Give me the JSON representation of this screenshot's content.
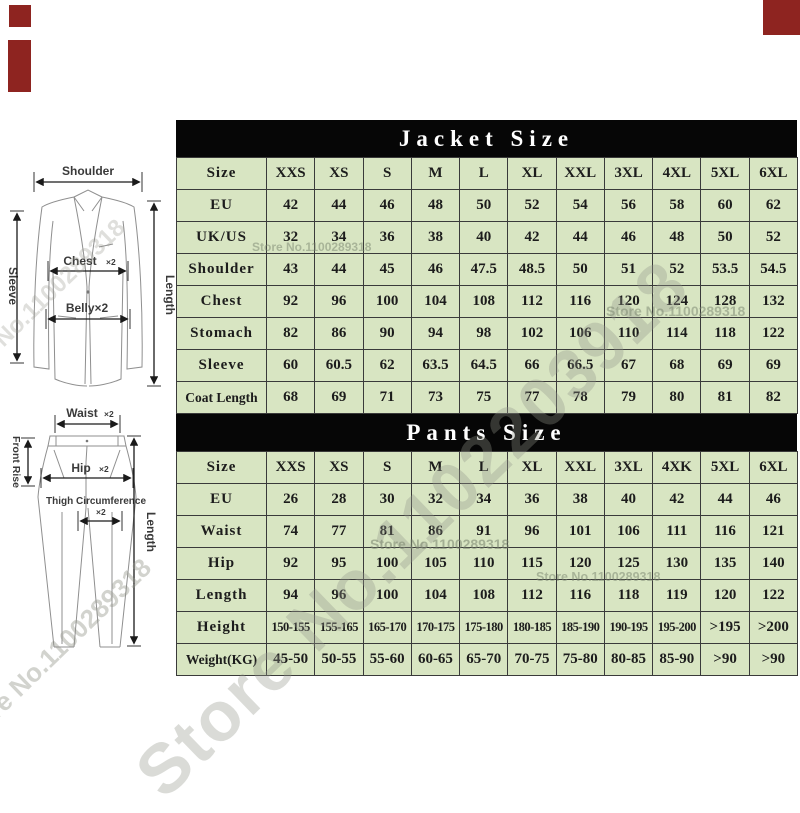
{
  "jacket": {
    "title": "Jacket Size",
    "rows": [
      {
        "label": "Size",
        "values": [
          "XXS",
          "XS",
          "S",
          "M",
          "L",
          "XL",
          "XXL",
          "3XL",
          "4XL",
          "5XL",
          "6XL"
        ]
      },
      {
        "label": "EU",
        "values": [
          "42",
          "44",
          "46",
          "48",
          "50",
          "52",
          "54",
          "56",
          "58",
          "60",
          "62"
        ]
      },
      {
        "label": "UK/US",
        "values": [
          "32",
          "34",
          "36",
          "38",
          "40",
          "42",
          "44",
          "46",
          "48",
          "50",
          "52"
        ]
      },
      {
        "label": "Shoulder",
        "values": [
          "43",
          "44",
          "45",
          "46",
          "47.5",
          "48.5",
          "50",
          "51",
          "52",
          "53.5",
          "54.5"
        ]
      },
      {
        "label": "Chest",
        "values": [
          "92",
          "96",
          "100",
          "104",
          "108",
          "112",
          "116",
          "120",
          "124",
          "128",
          "132"
        ]
      },
      {
        "label": "Stomach",
        "values": [
          "82",
          "86",
          "90",
          "94",
          "98",
          "102",
          "106",
          "110",
          "114",
          "118",
          "122"
        ]
      },
      {
        "label": "Sleeve",
        "values": [
          "60",
          "60.5",
          "62",
          "63.5",
          "64.5",
          "66",
          "66.5",
          "67",
          "68",
          "69",
          "69"
        ]
      },
      {
        "label": "Coat Length",
        "values": [
          "68",
          "69",
          "71",
          "73",
          "75",
          "77",
          "78",
          "79",
          "80",
          "81",
          "82"
        ]
      }
    ]
  },
  "pants": {
    "title": "Pants Size",
    "rows": [
      {
        "label": "Size",
        "values": [
          "XXS",
          "XS",
          "S",
          "M",
          "L",
          "XL",
          "XXL",
          "3XL",
          "4XK",
          "5XL",
          "6XL"
        ]
      },
      {
        "label": "EU",
        "values": [
          "26",
          "28",
          "30",
          "32",
          "34",
          "36",
          "38",
          "40",
          "42",
          "44",
          "46"
        ]
      },
      {
        "label": "Waist",
        "values": [
          "74",
          "77",
          "81",
          "86",
          "91",
          "96",
          "101",
          "106",
          "111",
          "116",
          "121"
        ]
      },
      {
        "label": "Hip",
        "values": [
          "92",
          "95",
          "100",
          "105",
          "110",
          "115",
          "120",
          "125",
          "130",
          "135",
          "140"
        ]
      },
      {
        "label": "Length",
        "values": [
          "94",
          "96",
          "100",
          "104",
          "108",
          "112",
          "116",
          "118",
          "119",
          "120",
          "122"
        ]
      },
      {
        "label": "Height",
        "values": [
          "150-155",
          "155-165",
          "165-170",
          "170-175",
          "175-180",
          "180-185",
          "185-190",
          "190-195",
          "195-200",
          ">195",
          ">200"
        ]
      },
      {
        "label": "Weight(KG)",
        "values": [
          "45-50",
          "50-55",
          "55-60",
          "60-65",
          "65-70",
          "70-75",
          "75-80",
          "80-85",
          "85-90",
          ">90",
          ">90"
        ]
      }
    ]
  },
  "jacket_diagram": {
    "shoulder": "Shoulder",
    "chest": "Chest",
    "chest_x2": "×2",
    "belly": "Belly×2",
    "sleeve": "Sleeve",
    "length": "Length"
  },
  "pants_diagram": {
    "waist": "Waist",
    "waist_x2": "×2",
    "front_rise": "Front Rise",
    "hip": "Hip",
    "hip_x2": "×2",
    "thigh": "Thigh Circumference",
    "thigh_x2": "×2",
    "length": "Length"
  },
  "watermark": {
    "large": "Store No.1102203918",
    "small": "Store No.1100289318"
  }
}
